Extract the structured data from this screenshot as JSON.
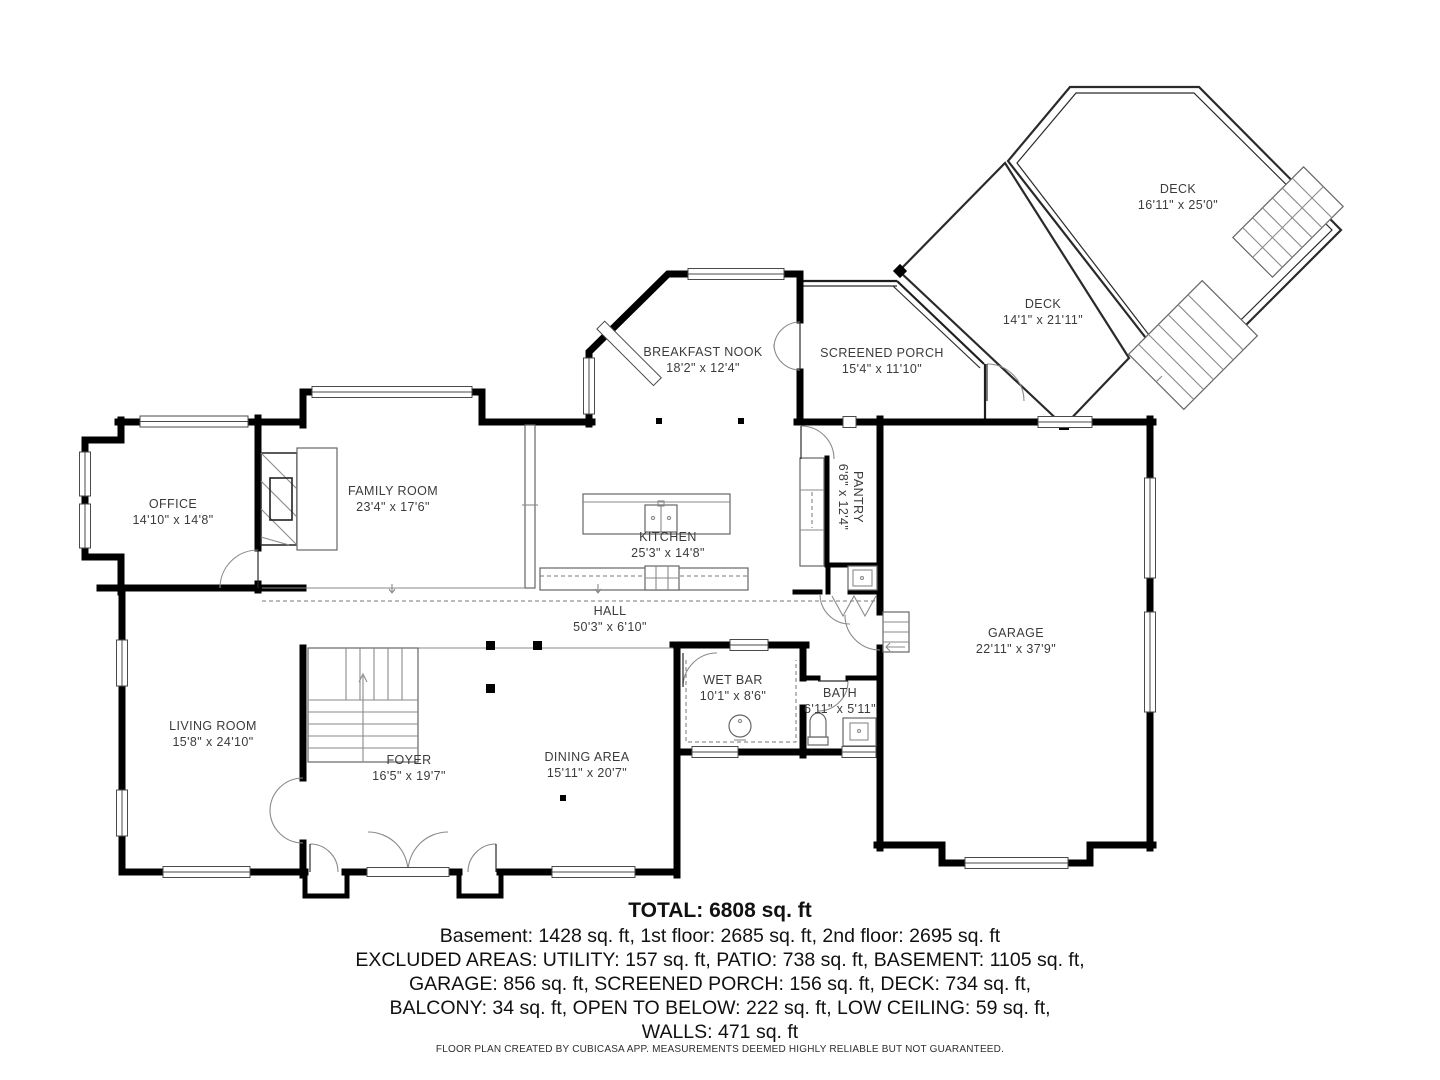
{
  "plan": {
    "rooms": [
      {
        "name": "DECK",
        "dims": "16'11\" x 25'0\""
      },
      {
        "name": "DECK",
        "dims": "14'1\" x 21'11\""
      },
      {
        "name": "SCREENED PORCH",
        "dims": "15'4\" x 11'10\""
      },
      {
        "name": "BREAKFAST NOOK",
        "dims": "18'2\" x 12'4\""
      },
      {
        "name": "PANTRY",
        "dims": "6'8\" x 12'4\""
      },
      {
        "name": "FAMILY ROOM",
        "dims": "23'4\" x 17'6\""
      },
      {
        "name": "OFFICE",
        "dims": "14'10\" x 14'8\""
      },
      {
        "name": "KITCHEN",
        "dims": "25'3\" x 14'8\""
      },
      {
        "name": "HALL",
        "dims": "50'3\" x 6'10\""
      },
      {
        "name": "GARAGE",
        "dims": "22'11\" x 37'9\""
      },
      {
        "name": "LIVING ROOM",
        "dims": "15'8\" x 24'10\""
      },
      {
        "name": "WET BAR",
        "dims": "10'1\" x 8'6\""
      },
      {
        "name": "BATH",
        "dims": "6'11\" x 5'11\""
      },
      {
        "name": "FOYER",
        "dims": "16'5\" x 19'7\""
      },
      {
        "name": "DINING AREA",
        "dims": "15'11\" x 20'7\""
      }
    ],
    "summary": {
      "total": "TOTAL: 6808 sq. ft",
      "lines": [
        "Basement: 1428 sq. ft, 1st floor: 2685 sq. ft, 2nd floor: 2695 sq. ft",
        "EXCLUDED AREAS: UTILITY: 157 sq. ft, PATIO: 738 sq. ft, BASEMENT: 1105 sq. ft,",
        "GARAGE: 856 sq. ft, SCREENED PORCH: 156 sq. ft, DECK: 734 sq. ft,",
        "BALCONY: 34 sq. ft, OPEN TO BELOW: 222 sq. ft, LOW CEILING: 59 sq. ft,",
        "WALLS: 471 sq. ft"
      ]
    },
    "footer": "FLOOR PLAN CREATED BY CUBICASA APP. MEASUREMENTS DEEMED HIGHLY RELIABLE BUT NOT GUARANTEED.",
    "colors": {
      "wall": "#000000",
      "thin_line": "#2a2a2a",
      "label_text": "#3b3b3b"
    }
  }
}
